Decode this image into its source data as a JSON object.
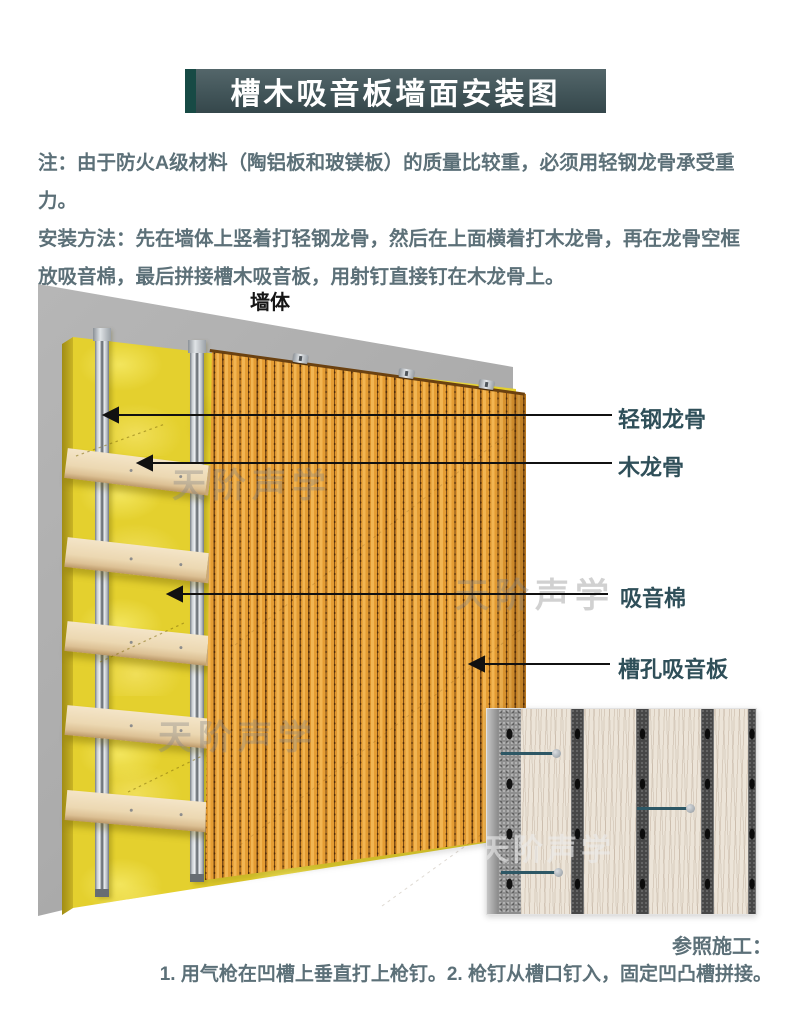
{
  "title": "槽木吸音板墙面安装图",
  "note": {
    "lines": [
      "注：由于防火A级材料（陶铝板和玻镁板）的质量比较重，必须用轻钢龙骨承受重力。",
      "安装方法：先在墙体上竖着打轻钢龙骨，然后在上面横着打木龙骨，再在龙骨空框",
      "放吸音棉，最后拼接槽木吸音板，用射钉直接钉在木龙骨上。"
    ]
  },
  "diagram": {
    "wall_label": "墙体",
    "callouts": [
      {
        "label": "轻钢龙骨"
      },
      {
        "label": "木龙骨"
      },
      {
        "label": "吸音棉"
      },
      {
        "label": "槽孔吸音板"
      }
    ],
    "watermark": "天阶声学"
  },
  "footer": {
    "heading": "参照施工：",
    "steps": "1. 用气枪在凹槽上垂直打上枪钉。2. 枪钉从槽口钉入，固定凹凸槽拼接。"
  },
  "colors": {
    "banner_bg": "#45585c",
    "banner_accent": "#174a45",
    "banner_text": "#ffffff",
    "note_text": "#5c7078",
    "callout_text": "#2f4f59",
    "wall_gray": "#ababab",
    "insulation_yellow": "#e4d02e",
    "stud_silver": "#c8cdd2",
    "batten_wood": "#ecd8b2",
    "panel_orange": "#eaa53e",
    "nail_teal": "#2d5765"
  }
}
